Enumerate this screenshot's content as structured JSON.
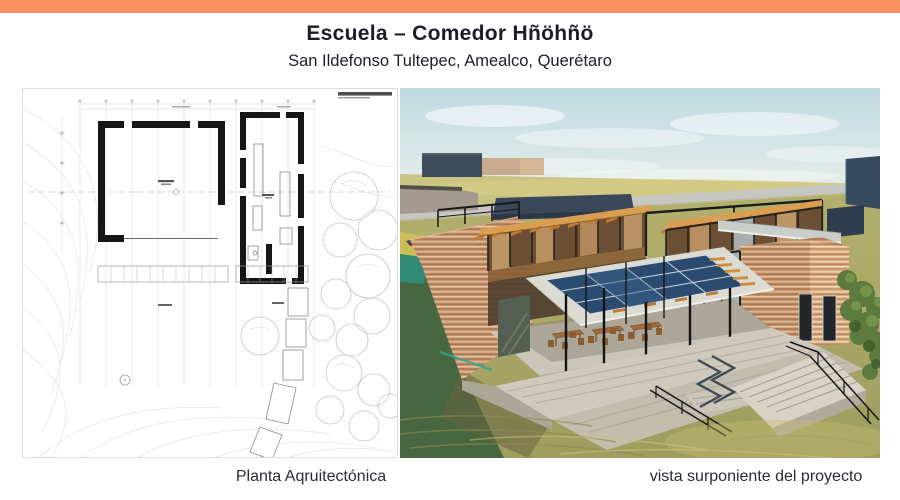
{
  "header": {
    "title": "Escuela – Comedor Hñöhñö",
    "subtitle": "San Ildefonso Tultepec, Amealco, Querétaro"
  },
  "figures": {
    "plan": {
      "caption": "Planta Aqruitectónica"
    },
    "render": {
      "caption": "vista surponiente del proyecto"
    }
  },
  "colors": {
    "accent": "#f99161",
    "title_color": "#1d1d27",
    "caption_color": "#2b2b33",
    "plan_wall": "#161616",
    "render_sky": "#c5dde3",
    "render_earth": "#c89a75",
    "render_navy": "#3b4859",
    "render_grass": "#aaa96a",
    "render_solar": "#2b4c70"
  }
}
